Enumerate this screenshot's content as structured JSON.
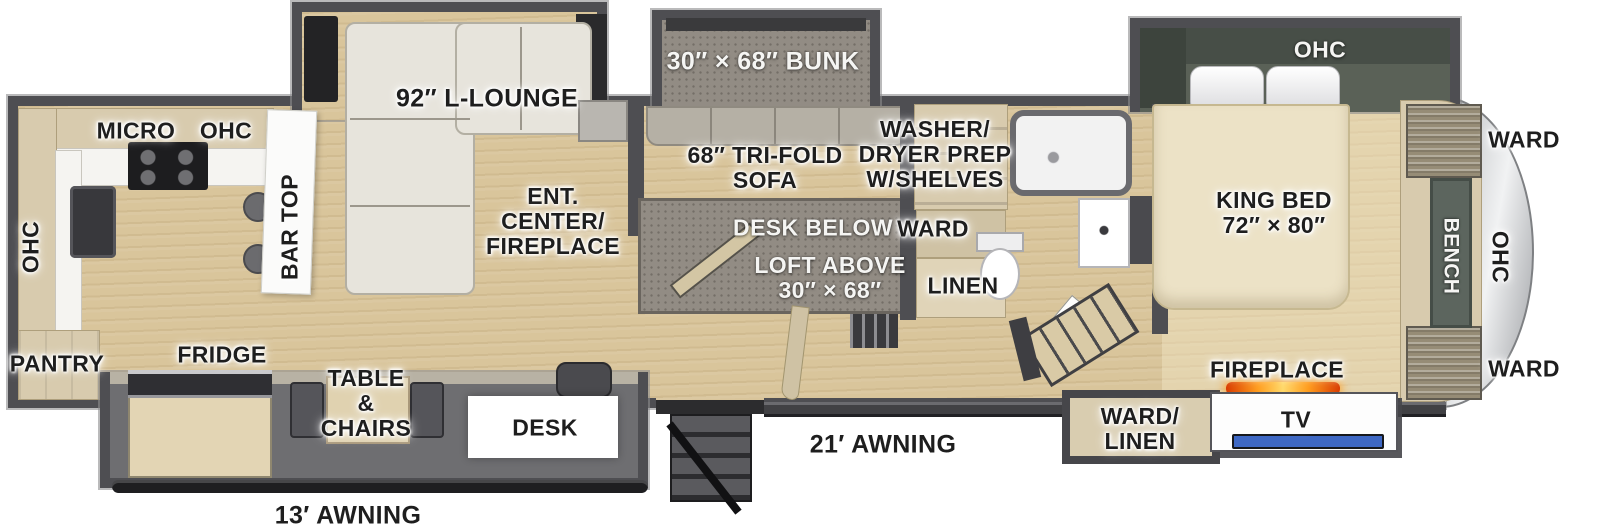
{
  "colors": {
    "floor_wood": "#d9c59b",
    "wall_gray": "#4e4e52",
    "cabinet_tan": "#d8cbae",
    "slideout_sage": "#5a6157",
    "bed_cream": "#ece2c6",
    "fireplace_glow": "#ff9d1e",
    "tv_screen": "#3e68c4",
    "front_cap_silver": "#d7d9db",
    "label_dark": "#1e1e1e",
    "label_light": "#f5f5f3"
  },
  "labels": {
    "kitchen": {
      "micro": "MICRO",
      "ohc_top": "OHC",
      "ohc_left": "OHC",
      "bar_top": "BAR TOP",
      "pantry": "PANTRY",
      "fridge": "FRIDGE"
    },
    "living": {
      "lounge": "92″ L-LOUNGE",
      "ent_center": "ENT.\nCENTER/\nFIREPLACE"
    },
    "dinette": {
      "table_chairs": "TABLE\n&\nCHAIRS",
      "desk": "DESK"
    },
    "bunk_loft": {
      "bunk": "30″ × 68″ BUNK",
      "tri_fold_sofa": "68″ TRI-FOLD\nSOFA",
      "desk_below": "DESK BELOW",
      "loft_above": "LOFT ABOVE\n30″ × 68″"
    },
    "utility": {
      "washer_dryer": "WASHER/\nDRYER PREP\nW/SHELVES",
      "ward": "WARD",
      "linen": "LINEN"
    },
    "bedroom": {
      "king_bed": "KING BED\n72″ × 80″",
      "ohc": "OHC",
      "fireplace": "FIREPLACE",
      "tv": "TV",
      "ward_linen": "WARD/\nLINEN"
    },
    "front_cap": {
      "ward_top": "WARD",
      "ohc_side": "OHC",
      "bench": "BENCH",
      "ward_bottom": "WARD"
    },
    "exterior": {
      "awning_21": "21′ AWNING",
      "awning_13": "13′ AWNING"
    }
  }
}
